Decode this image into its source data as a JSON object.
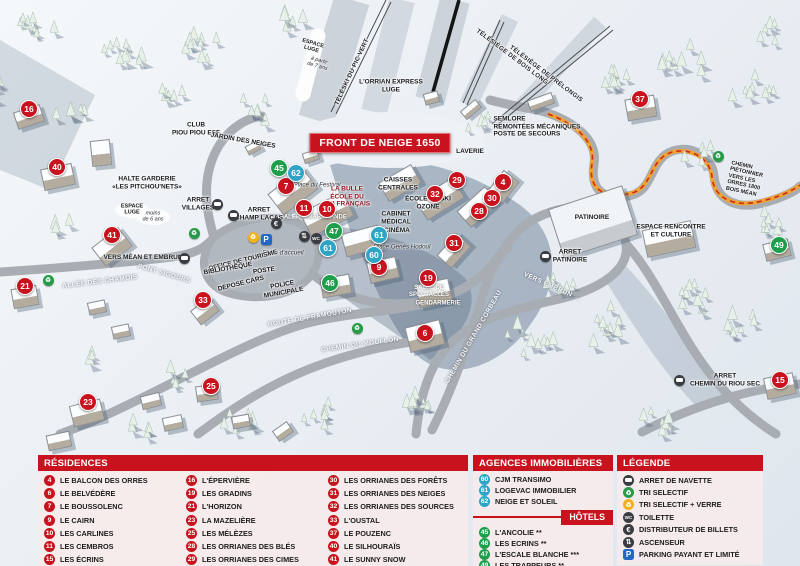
{
  "colors": {
    "red": "#c8131f",
    "green": "#1d9e4b",
    "blue": "#2ea4c6",
    "dark_icon": "#393c40",
    "yellow": "#f0b11f",
    "parking_blue": "#2268c4",
    "path_orange": "#f0a232"
  },
  "icon_glyphs": {
    "bus": "",
    "recg": "♻",
    "recy": "♻",
    "park": "P",
    "euro": "€",
    "wc": "WC",
    "lift": "⇅"
  },
  "map": {
    "front_sign": "FRONT DE NEIGE 1650",
    "markers": [
      {
        "n": 16,
        "t": "r",
        "x": 28,
        "y": 108
      },
      {
        "n": 40,
        "t": "r",
        "x": 56,
        "y": 166
      },
      {
        "n": 41,
        "t": "r",
        "x": 111,
        "y": 234
      },
      {
        "n": 21,
        "t": "r",
        "x": 24,
        "y": 285
      },
      {
        "n": 33,
        "t": "r",
        "x": 202,
        "y": 299
      },
      {
        "n": 23,
        "t": "r",
        "x": 87,
        "y": 401
      },
      {
        "n": 25,
        "t": "r",
        "x": 210,
        "y": 385
      },
      {
        "n": 7,
        "t": "r",
        "x": 285,
        "y": 185
      },
      {
        "n": 11,
        "t": "r",
        "x": 303,
        "y": 207
      },
      {
        "n": 10,
        "t": "r",
        "x": 326,
        "y": 208
      },
      {
        "n": 9,
        "t": "r",
        "x": 378,
        "y": 266
      },
      {
        "n": 19,
        "t": "r",
        "x": 427,
        "y": 277
      },
      {
        "n": 6,
        "t": "r",
        "x": 424,
        "y": 332
      },
      {
        "n": 29,
        "t": "r",
        "x": 456,
        "y": 179
      },
      {
        "n": 32,
        "t": "r",
        "x": 434,
        "y": 193
      },
      {
        "n": 28,
        "t": "r",
        "x": 478,
        "y": 210
      },
      {
        "n": 30,
        "t": "r",
        "x": 491,
        "y": 197
      },
      {
        "n": 4,
        "t": "r",
        "x": 502,
        "y": 181
      },
      {
        "n": 31,
        "t": "r",
        "x": 453,
        "y": 242
      },
      {
        "n": 37,
        "t": "r",
        "x": 639,
        "y": 98
      },
      {
        "n": 15,
        "t": "r",
        "x": 779,
        "y": 379
      },
      {
        "n": 45,
        "t": "g",
        "x": 278,
        "y": 167
      },
      {
        "n": 47,
        "t": "g",
        "x": 333,
        "y": 230
      },
      {
        "n": 46,
        "t": "g",
        "x": 329,
        "y": 282
      },
      {
        "n": 49,
        "t": "g",
        "x": 778,
        "y": 244
      },
      {
        "n": 62,
        "t": "b",
        "x": 295,
        "y": 172
      },
      {
        "n": 61,
        "t": "b",
        "x": 327,
        "y": 247
      },
      {
        "n": 61,
        "t": "b",
        "x": 378,
        "y": 234
      },
      {
        "n": 60,
        "t": "b",
        "x": 373,
        "y": 254
      }
    ],
    "icons": [
      {
        "t": "recg",
        "x": 194,
        "y": 233
      },
      {
        "t": "recg",
        "x": 48,
        "y": 280
      },
      {
        "t": "recg",
        "x": 357,
        "y": 328
      },
      {
        "t": "recg",
        "x": 718,
        "y": 156
      },
      {
        "t": "recy",
        "x": 253,
        "y": 237
      },
      {
        "t": "park",
        "x": 266,
        "y": 239
      },
      {
        "t": "euro",
        "x": 276,
        "y": 223
      },
      {
        "t": "wc",
        "x": 316,
        "y": 238
      },
      {
        "t": "lift",
        "x": 304,
        "y": 236
      },
      {
        "t": "bus",
        "x": 217,
        "y": 204
      },
      {
        "t": "bus",
        "x": 233,
        "y": 215
      },
      {
        "t": "bus",
        "x": 184,
        "y": 258
      },
      {
        "t": "bus",
        "x": 545,
        "y": 256
      },
      {
        "t": "bus",
        "x": 679,
        "y": 380
      }
    ],
    "labels": [
      {
        "t": "CLUB\nPIOU PIOU ESF",
        "x": 196,
        "y": 129
      },
      {
        "t": "JARDIN DES NEIGES",
        "x": 243,
        "y": 141,
        "r": 10
      },
      {
        "t": "ESPACE\nLUGE",
        "x": 312,
        "y": 47,
        "r": 16,
        "c": "tiny"
      },
      {
        "t": "à partir\nde 7 ans",
        "x": 318,
        "y": 64,
        "r": 16,
        "c": "it tiny"
      },
      {
        "t": "TÉLÉSKI DU PIC VERT",
        "x": 352,
        "y": 72,
        "r": -65,
        "c": "lift"
      },
      {
        "t": "L'ORRIAN EXPRESS\nLUGE",
        "x": 391,
        "y": 86
      },
      {
        "t": "TÉLÉSIÈGE DE BOIS LONG",
        "x": 512,
        "y": 57,
        "r": 37,
        "c": "lift"
      },
      {
        "t": "TÉLÉSIÈGE DE PRÉLONGIS",
        "x": 546,
        "y": 74,
        "r": 37,
        "c": "lift"
      },
      {
        "t": "SEMLORE\nREMONTÉES MÉCANIQUES\nPOSTE DE SECOURS",
        "x": 537,
        "y": 127,
        "c": "left"
      },
      {
        "t": "LAVERIE",
        "x": 470,
        "y": 152
      },
      {
        "t": "CAISSES\nCENTRALES",
        "x": 398,
        "y": 184
      },
      {
        "t": "Place du Festival",
        "x": 317,
        "y": 185,
        "c": "it"
      },
      {
        "t": "LA BULLE\nÉCOLE DU\nSKI FRANÇAIS",
        "x": 347,
        "y": 197,
        "c": "esf"
      },
      {
        "t": "GALERIE MARCHANDE",
        "x": 313,
        "y": 218,
        "c": "wt"
      },
      {
        "t": "ARRET\nVILLAGES",
        "x": 198,
        "y": 204
      },
      {
        "t": "ARRET\nCHAMP LACAS",
        "x": 259,
        "y": 214
      },
      {
        "t": "ÉCOLE DE SKI\nOZONE",
        "x": 428,
        "y": 203
      },
      {
        "t": "CABINET\nMÉDICAL",
        "x": 396,
        "y": 218
      },
      {
        "t": "CINÉMA",
        "x": 397,
        "y": 231
      },
      {
        "t": "Place Genès Hodoul",
        "x": 402,
        "y": 247,
        "c": "it"
      },
      {
        "t": "Place d'accueil",
        "x": 283,
        "y": 253,
        "c": "it"
      },
      {
        "t": "OFFICE DE TOURISME",
        "x": 243,
        "y": 261,
        "r": -14
      },
      {
        "t": "BIBLIOTHÈQUE",
        "x": 228,
        "y": 269,
        "r": -10
      },
      {
        "t": "POSTE",
        "x": 264,
        "y": 271,
        "r": -8
      },
      {
        "t": "DÉPOSE CARS",
        "x": 241,
        "y": 284,
        "r": -14
      },
      {
        "t": "POLICE\nMUNICIPALE",
        "x": 283,
        "y": 289,
        "r": -10
      },
      {
        "t": "SALLE DE\nSPECTACLES",
        "x": 429,
        "y": 292,
        "c": "wt"
      },
      {
        "t": "GENDARMERIE",
        "x": 438,
        "y": 304,
        "c": "wt"
      },
      {
        "t": "PATINOIRE",
        "x": 592,
        "y": 218
      },
      {
        "t": "ARRET\nPATINOIRE",
        "x": 570,
        "y": 256
      },
      {
        "t": "VERS EMBRUN →",
        "x": 552,
        "y": 287,
        "r": 24,
        "c": "rd"
      },
      {
        "t": "ESPACE RENCONTRE\nET CULTURE",
        "x": 671,
        "y": 231
      },
      {
        "t": "CHEMIN PIÉTONNIER\nVERS LES ORRES 1800\nBOIS MÉAN",
        "x": 752,
        "y": 181,
        "r": 12,
        "c": "tiny left"
      },
      {
        "t": "VERS MÉAN ET EMBRUN",
        "x": 143,
        "y": 258
      },
      {
        "t": "PONT SIGOURS",
        "x": 164,
        "y": 274,
        "r": 16,
        "c": "rd"
      },
      {
        "t": "ALLÉE DES CHAMOIS",
        "x": 100,
        "y": 282,
        "r": -7,
        "c": "rd"
      },
      {
        "t": "ROUTE DE PRAMOUTON",
        "x": 310,
        "y": 318,
        "r": -10,
        "c": "rd"
      },
      {
        "t": "CHEMIN DU MOUFLON",
        "x": 360,
        "y": 345,
        "r": -8,
        "c": "rd"
      },
      {
        "t": "CHEMIN DU GRAND CORBEAU",
        "x": 474,
        "y": 337,
        "r": -60,
        "c": "rd"
      },
      {
        "t": "ARRET\nCHEMIN DU RIOU SEC",
        "x": 725,
        "y": 380
      },
      {
        "t": "HALTE GARDERIE\n«LES PITCHOU'NETS»",
        "x": 147,
        "y": 183
      },
      {
        "t": "ESPACE\nLUGE",
        "x": 132,
        "y": 210,
        "c": "tiny"
      },
      {
        "t": "moins\nde 6 ans",
        "x": 153,
        "y": 217,
        "c": "it tiny"
      }
    ]
  },
  "legend": {
    "residences": {
      "title": "RÉSIDENCES",
      "columns": [
        [
          [
            4,
            "LE BALCON DES ORRES"
          ],
          [
            6,
            "LE BELVÉDÈRE"
          ],
          [
            7,
            "LE BOUSSOLENC"
          ],
          [
            9,
            "LE CAIRN"
          ],
          [
            10,
            "LES CARLINES"
          ],
          [
            11,
            "LES CEMBROS"
          ],
          [
            15,
            "LES ÉCRINS"
          ]
        ],
        [
          [
            16,
            "L'ÉPERVIÈRE"
          ],
          [
            19,
            "LES GRADINS"
          ],
          [
            21,
            "L'HORIZON"
          ],
          [
            23,
            "LA MAZELIÈRE"
          ],
          [
            25,
            "LES MÉLÈZES"
          ],
          [
            28,
            "LES ORRIANES DES BLÉS"
          ],
          [
            29,
            "LES ORRIANES DES CIMES"
          ]
        ],
        [
          [
            30,
            "LES ORRIANES DES FORÊTS"
          ],
          [
            31,
            "LES ORRIANES DES NEIGES"
          ],
          [
            32,
            "LES ORRIANES DES SOURCES"
          ],
          [
            33,
            "L'OUSTAL"
          ],
          [
            37,
            "LE POUZENC"
          ],
          [
            40,
            "LE SILHOURAÏS"
          ],
          [
            41,
            "LE SUNNY SNOW"
          ]
        ]
      ]
    },
    "agences": {
      "title": "AGENCES IMMOBILIÈRES",
      "items": [
        [
          60,
          "CJM TRANSIMO"
        ],
        [
          61,
          "LOGEVAC IMMOBILIER"
        ],
        [
          62,
          "NEIGE ET SOLEIL"
        ]
      ]
    },
    "hotels": {
      "title": "HÔTELS",
      "items": [
        [
          45,
          "L'ANCOLIE **"
        ],
        [
          46,
          "LES ECRINS **"
        ],
        [
          47,
          "L'ESCALE BLANCHE ***"
        ],
        [
          49,
          "LES TRAPPEURS **"
        ]
      ]
    },
    "legende": {
      "title": "LÉGENDE",
      "items": [
        {
          "icon": "bus",
          "label": "ARRET DE NAVETTE"
        },
        {
          "icon": "recg",
          "label": "TRI SELECTIF"
        },
        {
          "icon": "recy",
          "label": "TRI SELECTIF + VERRE"
        },
        {
          "icon": "wc",
          "label": "TOILETTE"
        },
        {
          "icon": "euro",
          "label": "DISTRIBUTEUR DE BILLETS"
        },
        {
          "icon": "lift",
          "label": "ASCENSEUR"
        },
        {
          "icon": "park",
          "label": "PARKING PAYANT ET LIMITÉ"
        }
      ]
    }
  }
}
